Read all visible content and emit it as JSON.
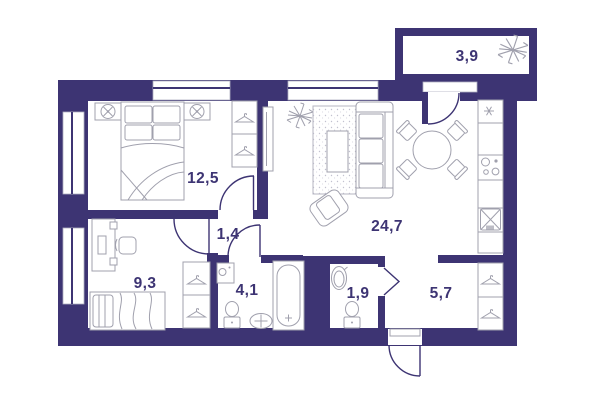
{
  "plan": {
    "type": "apartment-floor-plan",
    "colors": {
      "wall": "#3d3473",
      "furniture_outline": "#a0a0ad",
      "label_text": "#3d3473",
      "background": "#ffffff"
    },
    "rooms": [
      {
        "name": "bedroom",
        "area_label": "12,5"
      },
      {
        "name": "living-kitchen",
        "area_label": "24,7"
      },
      {
        "name": "balcony",
        "area_label": "3,9"
      },
      {
        "name": "office-bedroom",
        "area_label": "9,3"
      },
      {
        "name": "corridor",
        "area_label": "1,4"
      },
      {
        "name": "bathroom",
        "area_label": "4,1"
      },
      {
        "name": "wc",
        "area_label": "1,9"
      },
      {
        "name": "hallway",
        "area_label": "5,7"
      }
    ],
    "icons": [
      "plant-icon",
      "lamp-icon",
      "hanger-icon",
      "snowflake-icon",
      "cooktop-icon",
      "kitchen-sink-icon"
    ]
  }
}
